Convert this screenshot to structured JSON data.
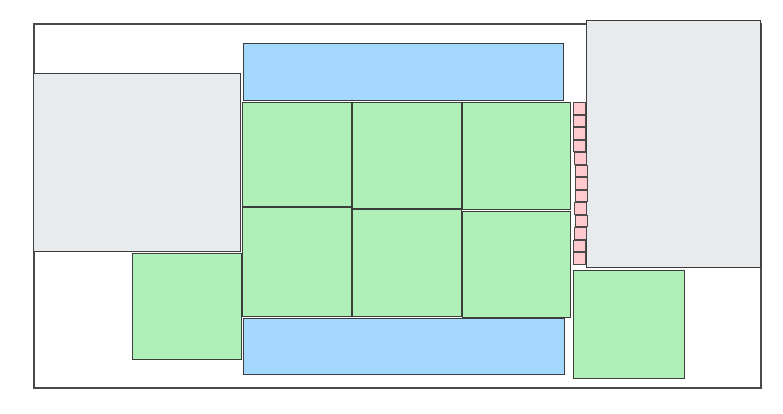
{
  "diagram": {
    "kind": "floorplan-block-diagram",
    "canvas": {
      "width": 783,
      "height": 414,
      "background": "#ffffff"
    },
    "colors": {
      "outline_fill": "#ffffff",
      "outline_stroke": "#4a4a4a",
      "block_stroke": "#3d3d3d",
      "green": "#aff0b8",
      "blue": "#a5d8ff",
      "gray": "#e8ebee",
      "pink": "#ffc9cd"
    },
    "outline": {
      "x": 33,
      "y": 23,
      "w": 729,
      "h": 366
    },
    "blocks": [
      {
        "name": "gray-block-left",
        "color": "gray",
        "x": 33,
        "y": 73,
        "w": 208,
        "h": 179
      },
      {
        "name": "gray-block-right",
        "color": "gray",
        "x": 586,
        "y": 20,
        "w": 175,
        "h": 248
      },
      {
        "name": "blue-band-top",
        "color": "blue",
        "x": 243,
        "y": 43,
        "w": 321,
        "h": 58
      },
      {
        "name": "blue-band-bottom",
        "color": "blue",
        "x": 243,
        "y": 318,
        "w": 322,
        "h": 57
      },
      {
        "name": "green-macro-r1c1",
        "color": "green",
        "x": 242,
        "y": 102,
        "w": 110,
        "h": 105
      },
      {
        "name": "green-macro-r1c2",
        "color": "green",
        "x": 352,
        "y": 102,
        "w": 110,
        "h": 107
      },
      {
        "name": "green-macro-r1c3",
        "color": "green",
        "x": 462,
        "y": 102,
        "w": 109,
        "h": 108
      },
      {
        "name": "green-macro-r2c1",
        "color": "green",
        "x": 242,
        "y": 207,
        "w": 110,
        "h": 110
      },
      {
        "name": "green-macro-r2c2",
        "color": "green",
        "x": 352,
        "y": 209,
        "w": 110,
        "h": 108
      },
      {
        "name": "green-macro-r2c3",
        "color": "green",
        "x": 462,
        "y": 211,
        "w": 109,
        "h": 107
      },
      {
        "name": "green-macro-bottom-left",
        "color": "green",
        "x": 132,
        "y": 253,
        "w": 110,
        "h": 107
      },
      {
        "name": "green-macro-bottom-right",
        "color": "green",
        "x": 573,
        "y": 270,
        "w": 112,
        "h": 109
      }
    ],
    "pink_cells": {
      "name": "pink-cell",
      "color": "pink",
      "cell_w": 13,
      "cell_h": 12.5,
      "cells": [
        {
          "x": 573,
          "y": 102.0
        },
        {
          "x": 573,
          "y": 114.5
        },
        {
          "x": 573,
          "y": 127.0
        },
        {
          "x": 573,
          "y": 139.5
        },
        {
          "x": 574,
          "y": 152.0
        },
        {
          "x": 575,
          "y": 164.5
        },
        {
          "x": 575,
          "y": 177.0
        },
        {
          "x": 575,
          "y": 189.5
        },
        {
          "x": 574,
          "y": 202.0
        },
        {
          "x": 575,
          "y": 214.5
        },
        {
          "x": 574,
          "y": 227.0
        },
        {
          "x": 573,
          "y": 239.5
        },
        {
          "x": 573,
          "y": 252.0
        }
      ]
    }
  }
}
